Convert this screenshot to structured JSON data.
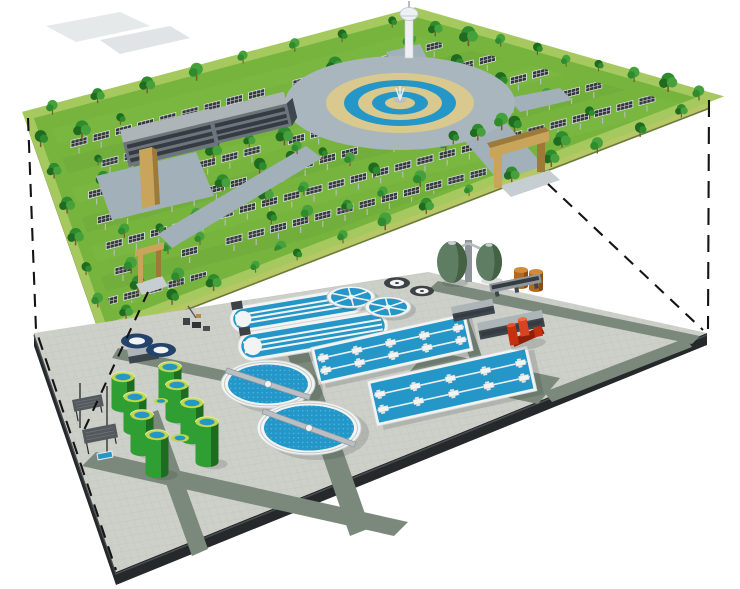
{
  "scene": {
    "type": "isometric-cutaway-illustration",
    "subject": "Solar park and gardens built on the roof deck of an underground wastewater treatment plant, shown as two stacked layers joined by dashed projection lines",
    "upper_layer": {
      "label": "rooftop-solar-park",
      "components": [
        {
          "name": "solar-panel-canopies",
          "approx_count": 180
        },
        {
          "name": "park-trees",
          "approx_count": 110
        },
        {
          "name": "fountain-plaza",
          "rings": [
            "stone ring road",
            "tan pavement",
            "water ring",
            "tan ring",
            "water ring",
            "fountain"
          ]
        },
        {
          "name": "observation-tower",
          "count": 1
        },
        {
          "name": "office-buildings",
          "count": 2
        },
        {
          "name": "entrance-gate-arches",
          "count": 2
        }
      ]
    },
    "lower_layer": {
      "label": "underground-treatment-plant",
      "components": [
        {
          "name": "oxidation-ditches",
          "count": 2
        },
        {
          "name": "secondary-clarifiers",
          "count": 2
        },
        {
          "name": "aeration-basins",
          "count": 2
        },
        {
          "name": "green-sludge-tanks",
          "count": 8
        },
        {
          "name": "egg-shaped-digesters",
          "count": 2
        },
        {
          "name": "covered-round-tanks",
          "count": 2
        },
        {
          "name": "radial-thickeners",
          "count": 2
        },
        {
          "name": "small-dark-tanks",
          "count": 2
        },
        {
          "name": "fuel-oil-tanks",
          "count": 2
        },
        {
          "name": "red-pump-unit",
          "count": 1
        },
        {
          "name": "plant-buildings",
          "count": 4
        },
        {
          "name": "shade-shelters",
          "count": 2
        }
      ]
    },
    "connectors": {
      "style": "dashed-projection-lines",
      "lines": 4
    },
    "colors": {
      "grass": "#77b43e",
      "lawnLight": "#8ac44e",
      "lawnDark": "#649a34",
      "slabSide": "#b6c766",
      "slabSideDark": "#97ab4e",
      "tree1": "#2e8b2e",
      "tree2": "#1f6b1f",
      "tree3": "#46a13c",
      "trunk": "#7a5c34",
      "panel": "#35393d",
      "panelFrame": "#dfe3e6",
      "path": "#a2b0b9",
      "plazaGrey": "#a9b6be",
      "tan": "#d9c98e",
      "water": "#2496c8",
      "waterLight": "#49b4e0",
      "white": "#f2f4f3",
      "navy": "#23436b",
      "building": "#6c757c",
      "buildingDark": "#3e464d",
      "roofLight": "#aeb5b9",
      "gate": "#c9a45b",
      "gateShade": "#9d7a39",
      "tower": "#eef1f3",
      "platform": "#cdcfc9",
      "tileLine": "#b7b9b2",
      "platformSide": "#26292b",
      "road": "#7b897d",
      "tankGreen": "#2f9e33",
      "tankGreenDark": "#1a6320",
      "tankRim": "#bfd64d",
      "egg": "#5f7d62",
      "eggShade": "#415c3f",
      "orange": "#b06a1e",
      "orangeLight": "#d18c3a",
      "red": "#c62f10",
      "redDark": "#8f1f08",
      "greyEquip": "#3c4246",
      "pavilion": "#53595d",
      "ramp": "#c6ced2",
      "dash": "#141414"
    }
  }
}
